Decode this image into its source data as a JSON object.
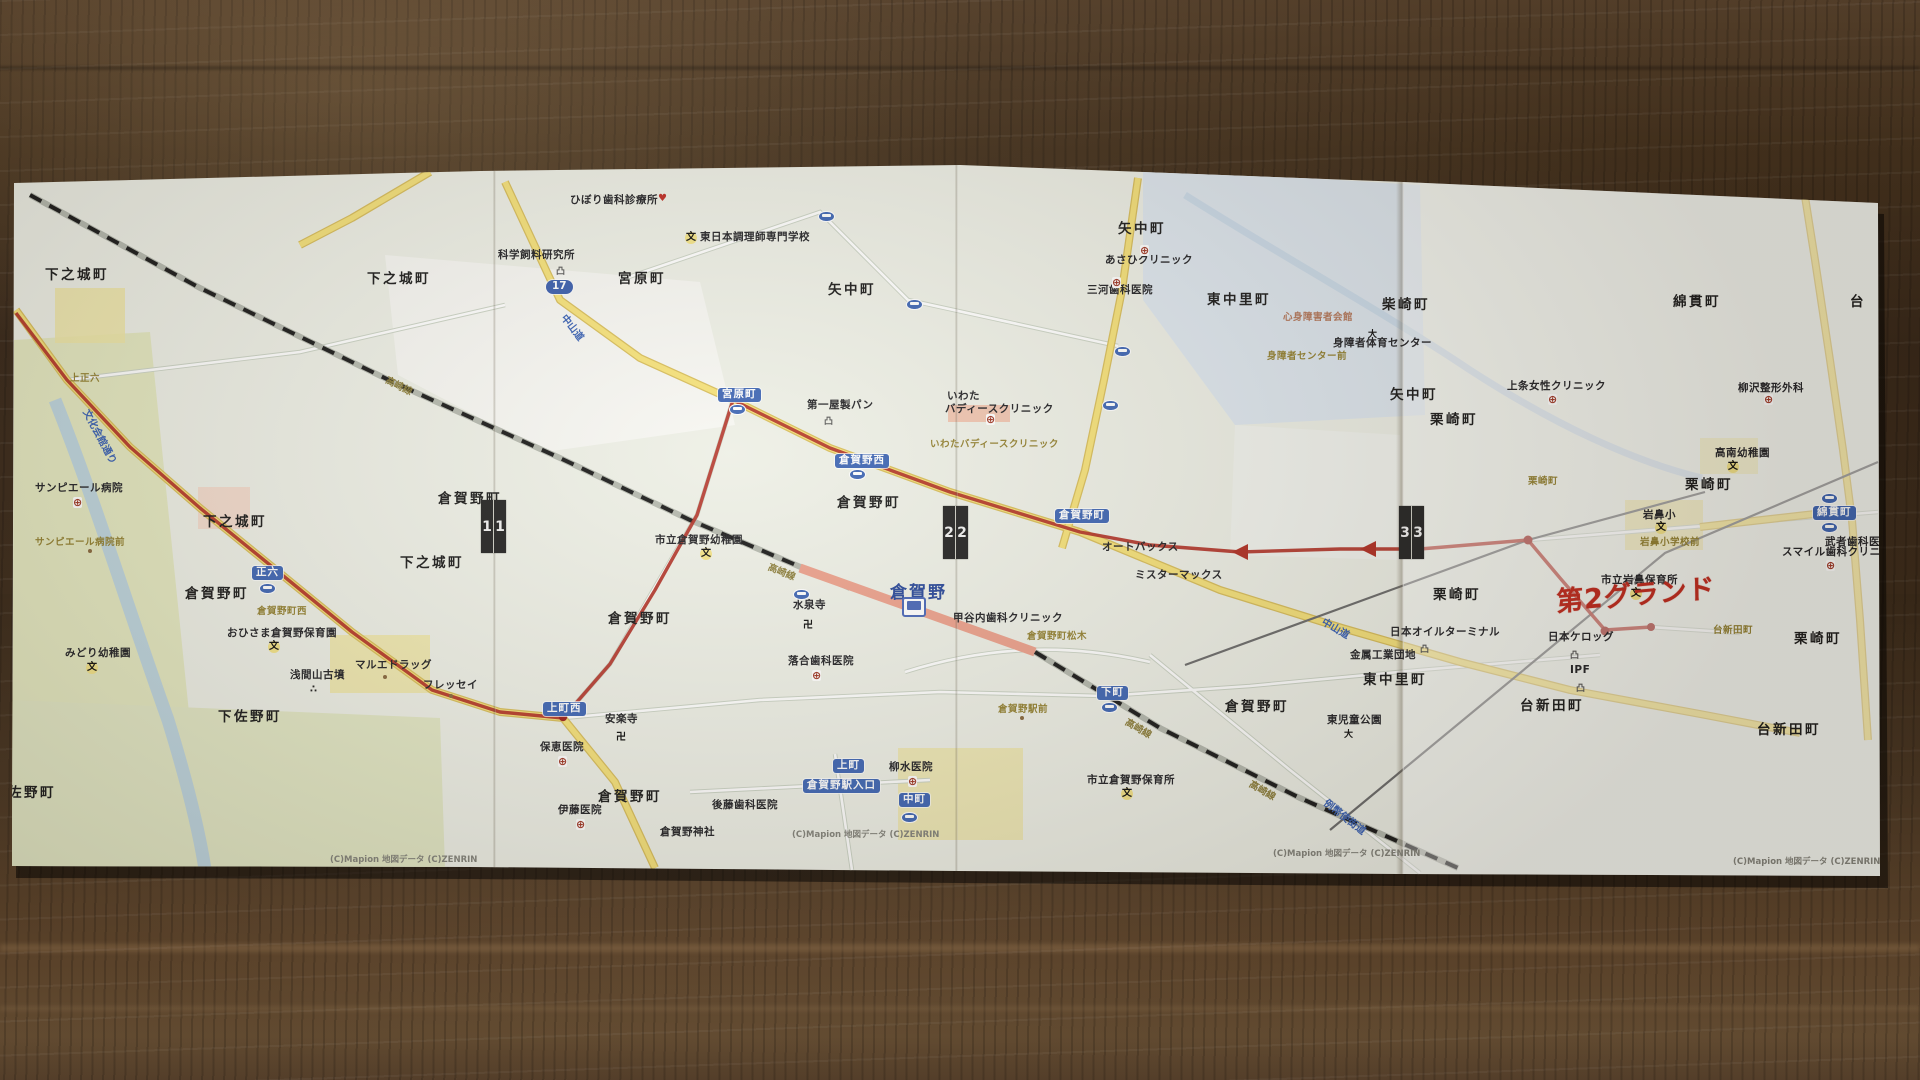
{
  "scene": {
    "description": "printed Mapion route map (4 folded sheets) lying on dark wooden table",
    "accent_route_color": "#b23227",
    "handwriting_color": "#c22c20",
    "paper_color": "#eef0e7",
    "wood_color": "#42301e"
  },
  "map": {
    "station": {
      "name": "倉賀野"
    },
    "handwriting": {
      "text": "第2グランド"
    },
    "towns": [
      {
        "t": "下之城町",
        "x": 45,
        "y": 268
      },
      {
        "t": "下之城町",
        "x": 367,
        "y": 272
      },
      {
        "t": "宮原町",
        "x": 618,
        "y": 272
      },
      {
        "t": "矢中町",
        "x": 828,
        "y": 283
      },
      {
        "t": "矢中町",
        "x": 1118,
        "y": 222
      },
      {
        "t": "下之城町",
        "x": 203,
        "y": 515
      },
      {
        "t": "下之城町",
        "x": 400,
        "y": 556
      },
      {
        "t": "倉賀野町",
        "x": 185,
        "y": 587
      },
      {
        "t": "倉賀野町",
        "x": 438,
        "y": 492
      },
      {
        "t": "倉賀野町",
        "x": 837,
        "y": 496
      },
      {
        "t": "倉賀野町",
        "x": 608,
        "y": 612
      },
      {
        "t": "東中里町",
        "x": 1207,
        "y": 293
      },
      {
        "t": "東中里町",
        "x": 1363,
        "y": 673
      },
      {
        "t": "柴崎町",
        "x": 1382,
        "y": 298
      },
      {
        "t": "矢中町",
        "x": 1390,
        "y": 388
      },
      {
        "t": "栗崎町",
        "x": 1430,
        "y": 413
      },
      {
        "t": "栗崎町",
        "x": 1685,
        "y": 478
      },
      {
        "t": "栗崎町",
        "x": 1433,
        "y": 588
      },
      {
        "t": "栗崎町",
        "x": 1794,
        "y": 632
      },
      {
        "t": "綿貫町",
        "x": 1673,
        "y": 295
      },
      {
        "t": "台",
        "x": 1850,
        "y": 295
      },
      {
        "t": "倉賀野町",
        "x": 1225,
        "y": 700
      },
      {
        "t": "下佐野町",
        "x": 218,
        "y": 710
      },
      {
        "t": "下佐野町",
        "x": -8,
        "y": 786
      },
      {
        "t": "台新田町",
        "x": 1520,
        "y": 699
      },
      {
        "t": "台新田町",
        "x": 1757,
        "y": 723
      },
      {
        "t": "倉賀野町",
        "x": 598,
        "y": 790
      }
    ],
    "pois": [
      {
        "t": "サンピエール病院",
        "x": 35,
        "y": 483
      },
      {
        "t": "みどり幼稚園",
        "x": 65,
        "y": 648
      },
      {
        "t": "おひさま倉賀野保育園",
        "x": 227,
        "y": 628
      },
      {
        "t": "マルエドラッグ",
        "x": 355,
        "y": 660
      },
      {
        "t": "フレッセイ",
        "x": 423,
        "y": 680
      },
      {
        "t": "浅間山古墳",
        "x": 290,
        "y": 670
      },
      {
        "t": "市立倉賀野幼稚園",
        "x": 655,
        "y": 535
      },
      {
        "t": "水泉寺",
        "x": 793,
        "y": 600
      },
      {
        "t": "落合歯科医院",
        "x": 788,
        "y": 656
      },
      {
        "t": "安楽寺",
        "x": 605,
        "y": 714
      },
      {
        "t": "保恵医院",
        "x": 540,
        "y": 742
      },
      {
        "t": "伊藤医院",
        "x": 558,
        "y": 805
      },
      {
        "t": "後藤歯科医院",
        "x": 712,
        "y": 800
      },
      {
        "t": "倉賀野神社",
        "x": 660,
        "y": 827
      },
      {
        "t": "柳水医院",
        "x": 889,
        "y": 762
      },
      {
        "t": "科学飼料研究所",
        "x": 498,
        "y": 250
      },
      {
        "t": "ひぼり歯科診療所",
        "x": 570,
        "y": 195
      },
      {
        "t": "東日本調理師専門学校",
        "x": 700,
        "y": 232
      },
      {
        "t": "第一屋製パン",
        "x": 807,
        "y": 400
      },
      {
        "t": "いわた",
        "x": 947,
        "y": 391
      },
      {
        "t": "バディースクリニック",
        "x": 945,
        "y": 404
      },
      {
        "t": "あさひクリニック",
        "x": 1105,
        "y": 255
      },
      {
        "t": "三河歯科医院",
        "x": 1087,
        "y": 285
      },
      {
        "t": "身障者体育センター",
        "x": 1333,
        "y": 338
      },
      {
        "t": "オートバックス",
        "x": 1102,
        "y": 542
      },
      {
        "t": "ミスターマックス",
        "x": 1135,
        "y": 570
      },
      {
        "t": "東児童公園",
        "x": 1327,
        "y": 715
      },
      {
        "t": "市立倉賀野保育所",
        "x": 1087,
        "y": 775
      },
      {
        "t": "甲谷内歯科クリニック",
        "x": 953,
        "y": 613
      },
      {
        "t": "日本オイルターミナル",
        "x": 1390,
        "y": 627
      },
      {
        "t": "金属工業団地",
        "x": 1350,
        "y": 650
      },
      {
        "t": "IPF",
        "x": 1570,
        "y": 665
      },
      {
        "t": "日本ケロッグ",
        "x": 1548,
        "y": 632
      },
      {
        "t": "市立岩鼻保育所",
        "x": 1601,
        "y": 575
      },
      {
        "t": "岩鼻小",
        "x": 1643,
        "y": 510
      },
      {
        "t": "高南幼稚園",
        "x": 1715,
        "y": 448
      },
      {
        "t": "上条女性クリニック",
        "x": 1507,
        "y": 381
      },
      {
        "t": "柳沢整形外科",
        "x": 1738,
        "y": 383
      },
      {
        "t": "スマイル歯科クリニック",
        "x": 1782,
        "y": 547
      },
      {
        "t": "武者歯科医院",
        "x": 1825,
        "y": 537
      }
    ],
    "olive": [
      {
        "t": "サンピエール病院前",
        "x": 35,
        "y": 538
      },
      {
        "t": "上正六",
        "x": 70,
        "y": 374
      },
      {
        "t": "倉賀野町西",
        "x": 257,
        "y": 607
      },
      {
        "t": "いわたバディースクリニック",
        "x": 930,
        "y": 440
      },
      {
        "t": "心身障害者会館",
        "x": 1283,
        "y": 313,
        "c": "brn"
      },
      {
        "t": "身障者センター前",
        "x": 1267,
        "y": 352
      },
      {
        "t": "栗崎町",
        "x": 1528,
        "y": 477
      },
      {
        "t": "岩鼻小学校前",
        "x": 1640,
        "y": 538
      },
      {
        "t": "台新田町",
        "x": 1713,
        "y": 626
      },
      {
        "t": "倉賀野町松木",
        "x": 1027,
        "y": 632
      },
      {
        "t": "倉賀野駅前",
        "x": 998,
        "y": 705
      }
    ],
    "signs": [
      {
        "t": "宮原町",
        "x": 718,
        "y": 388
      },
      {
        "t": "倉賀野西",
        "x": 835,
        "y": 454
      },
      {
        "t": "正六",
        "x": 252,
        "y": 566
      },
      {
        "t": "上町西",
        "x": 543,
        "y": 702
      },
      {
        "t": "中町",
        "x": 899,
        "y": 793
      },
      {
        "t": "下町",
        "x": 1097,
        "y": 686
      },
      {
        "t": "上町",
        "x": 833,
        "y": 759
      },
      {
        "t": "倉賀野駅入口",
        "x": 803,
        "y": 779
      },
      {
        "t": "倉賀野町",
        "x": 1055,
        "y": 509
      },
      {
        "t": "綿貫町",
        "x": 1813,
        "y": 506
      },
      {
        "t": "17",
        "x": 546,
        "y": 280,
        "c": "shield",
        "n": "route-17-shield"
      }
    ],
    "rotated": [
      {
        "t": "中山道",
        "x": 567,
        "y": 313,
        "d": 52,
        "c": "blue"
      },
      {
        "t": "中山道",
        "x": 1325,
        "y": 617,
        "d": 30,
        "c": "blue"
      },
      {
        "t": "文化会館通り",
        "x": 90,
        "y": 408,
        "d": 62,
        "c": "blue"
      },
      {
        "t": "例幣使街道",
        "x": 1328,
        "y": 798,
        "d": 38,
        "c": "blue"
      },
      {
        "t": "高崎線",
        "x": 388,
        "y": 376,
        "d": 27,
        "c": "olvr"
      },
      {
        "t": "高崎線",
        "x": 770,
        "y": 563,
        "d": 22,
        "c": "olvr"
      },
      {
        "t": "高崎線",
        "x": 1128,
        "y": 718,
        "d": 30,
        "c": "olvr"
      },
      {
        "t": "高崎線",
        "x": 1252,
        "y": 780,
        "d": 30,
        "c": "olvr"
      }
    ],
    "icons": [
      {
        "t": "文",
        "x": 86,
        "y": 662,
        "c": "ic-bun",
        "n": "school-icon"
      },
      {
        "t": "文",
        "x": 268,
        "y": 641,
        "c": "ic-bun",
        "n": "school-icon"
      },
      {
        "t": "文",
        "x": 700,
        "y": 548,
        "c": "ic-bun",
        "n": "school-icon"
      },
      {
        "t": "文",
        "x": 685,
        "y": 232,
        "c": "ic-bun",
        "n": "school-icon"
      },
      {
        "t": "文",
        "x": 1121,
        "y": 788,
        "c": "ic-bun",
        "n": "school-icon"
      },
      {
        "t": "文",
        "x": 1630,
        "y": 588,
        "c": "ic-bun",
        "n": "school-icon"
      },
      {
        "t": "文",
        "x": 1655,
        "y": 522,
        "c": "ic-bun",
        "n": "school-icon"
      },
      {
        "t": "文",
        "x": 1727,
        "y": 461,
        "c": "ic-bun",
        "n": "school-icon"
      },
      {
        "t": "⊕",
        "x": 73,
        "y": 497,
        "c": "ic-hosp",
        "n": "hospital-icon"
      },
      {
        "t": "⊕",
        "x": 812,
        "y": 670,
        "c": "ic-hosp",
        "n": "hospital-icon"
      },
      {
        "t": "⊕",
        "x": 558,
        "y": 756,
        "c": "ic-hosp",
        "n": "hospital-icon"
      },
      {
        "t": "⊕",
        "x": 576,
        "y": 819,
        "c": "ic-hosp",
        "n": "hospital-icon"
      },
      {
        "t": "⊕",
        "x": 908,
        "y": 776,
        "c": "ic-hosp",
        "n": "hospital-icon"
      },
      {
        "t": "⊕",
        "x": 986,
        "y": 414,
        "c": "ic-hosp",
        "n": "hospital-icon"
      },
      {
        "t": "⊕",
        "x": 1140,
        "y": 245,
        "c": "ic-hosp",
        "n": "hospital-icon"
      },
      {
        "t": "⊕",
        "x": 1112,
        "y": 277,
        "c": "ic-hosp",
        "n": "hospital-icon"
      },
      {
        "t": "⊕",
        "x": 1548,
        "y": 394,
        "c": "ic-hosp",
        "n": "hospital-icon"
      },
      {
        "t": "⊕",
        "x": 1764,
        "y": 394,
        "c": "ic-hosp",
        "n": "hospital-icon"
      },
      {
        "t": "⊕",
        "x": 1826,
        "y": 560,
        "c": "ic-hosp",
        "n": "hospital-icon"
      },
      {
        "t": "卍",
        "x": 803,
        "y": 616,
        "c": "ic-temp",
        "n": "temple-icon"
      },
      {
        "t": "卍",
        "x": 616,
        "y": 728,
        "c": "ic-temp",
        "n": "temple-icon"
      },
      {
        "t": "凸",
        "x": 556,
        "y": 264,
        "c": "ic-fact",
        "n": "factory-icon"
      },
      {
        "t": "凸",
        "x": 824,
        "y": 414,
        "c": "ic-fact",
        "n": "factory-icon"
      },
      {
        "t": "凸",
        "x": 1420,
        "y": 642,
        "c": "ic-fact",
        "n": "factory-icon"
      },
      {
        "t": "凸",
        "x": 1576,
        "y": 681,
        "c": "ic-fact",
        "n": "factory-icon"
      },
      {
        "t": "凸",
        "x": 1570,
        "y": 648,
        "c": "ic-fact",
        "n": "factory-icon"
      },
      {
        "t": "∴",
        "x": 310,
        "y": 684,
        "c": "ic-dots",
        "n": "tumulus-icon"
      },
      {
        "t": "大",
        "x": 1368,
        "y": 327,
        "c": "ic-man",
        "n": "gym-icon"
      },
      {
        "t": "大",
        "x": 1344,
        "y": 727,
        "c": "ic-man",
        "n": "park-icon"
      },
      {
        "t": "♥",
        "x": 658,
        "y": 193,
        "c": "ic-heart",
        "n": "clinic-heart-icon"
      },
      {
        "t": "",
        "x": 383,
        "y": 675,
        "c": "ic-dot",
        "n": "poi-dot-icon"
      },
      {
        "t": "",
        "x": 449,
        "y": 694,
        "c": "ic-dot",
        "n": "poi-dot-icon"
      },
      {
        "t": "",
        "x": 88,
        "y": 549,
        "c": "ic-dot",
        "n": "poi-dot-icon"
      },
      {
        "t": "",
        "x": 1020,
        "y": 716,
        "c": "ic-dot",
        "n": "poi-dot-icon"
      }
    ],
    "bus_stops": [
      {
        "x": 729,
        "y": 404
      },
      {
        "x": 849,
        "y": 469
      },
      {
        "x": 259,
        "y": 583
      },
      {
        "x": 901,
        "y": 812
      },
      {
        "x": 1101,
        "y": 702
      },
      {
        "x": 1821,
        "y": 493
      },
      {
        "x": 1821,
        "y": 522
      },
      {
        "x": 818,
        "y": 211
      },
      {
        "x": 906,
        "y": 299
      },
      {
        "x": 1114,
        "y": 346
      },
      {
        "x": 1102,
        "y": 400
      },
      {
        "x": 793,
        "y": 589
      }
    ],
    "markers": [
      {
        "d1": "1",
        "d2": "1",
        "x": 481,
        "y": 500,
        "n": "fold-marker-1"
      },
      {
        "d1": "2",
        "d2": "2",
        "x": 943,
        "y": 506,
        "n": "fold-marker-2"
      },
      {
        "d1": "3",
        "d2": "3",
        "x": 1399,
        "y": 506,
        "n": "fold-marker-3"
      }
    ],
    "copyright": [
      {
        "t": "(C)Mapion 地図データ (C)ZENRIN",
        "x": 330,
        "y": 856
      },
      {
        "t": "(C)Mapion 地図データ (C)ZENRIN",
        "x": 792,
        "y": 831
      },
      {
        "t": "(C)Mapion 地図データ (C)ZENRIN",
        "x": 1273,
        "y": 850
      },
      {
        "t": "(C)Mapion 地図データ (C)ZENRIN",
        "x": 1733,
        "y": 858
      }
    ]
  }
}
